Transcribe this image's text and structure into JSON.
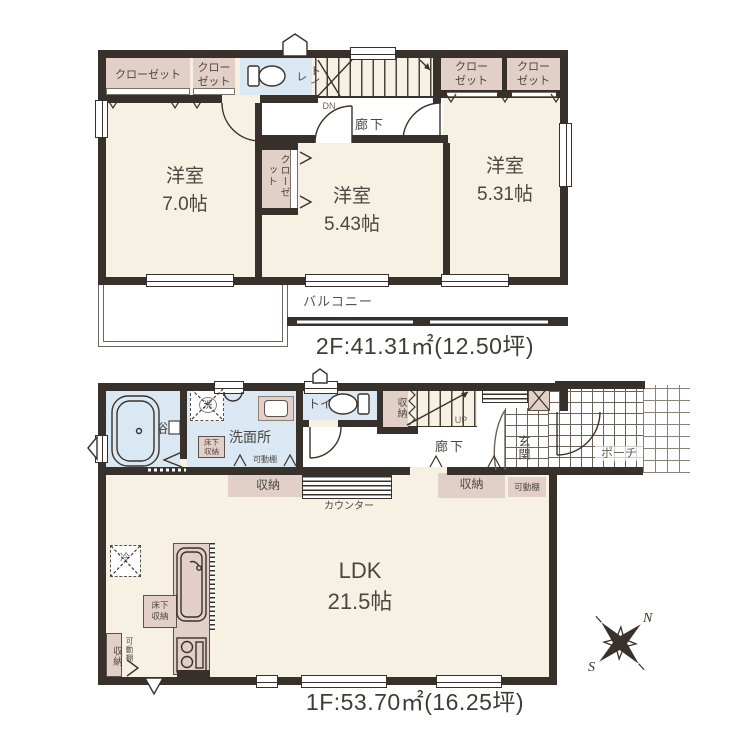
{
  "colors": {
    "wall": "#37302b",
    "floor_cream": "#f6f1e3",
    "closet_pink": "#e2cfc7",
    "water_blue": "#d9e8f2",
    "line_dark": "#3a312c",
    "text": "#4b4743"
  },
  "compass": {
    "north": "N",
    "south": "S"
  },
  "f2": {
    "area_text": "2F:41.31㎡(12.50坪)",
    "labels": {
      "closet_a": "クローゼット",
      "closet_b": "クロー\nゼット",
      "toilet": "トイレ",
      "stairs_dn": "DN",
      "hallway": "廊下",
      "closet_c": "クロー\nゼット",
      "closet_d": "クロー\nゼット",
      "closet_mid": "クローゼット",
      "room_a": "洋室\n7.0帖",
      "room_b": "洋室\n5.43帖",
      "room_c": "洋室\n5.31帖",
      "balcony": "バルコニー"
    }
  },
  "f1": {
    "area_text": "1F:53.70㎡(16.25坪)",
    "labels": {
      "bathroom": "浴室",
      "washer": "洗",
      "washroom": "洗面所",
      "underfloor_a": "床下\n収納",
      "shelf_a": "可動棚",
      "toilet": "トイレ",
      "storage_a": "収納",
      "stairs_up": "UP",
      "hallway": "廊下",
      "entrance": "玄関",
      "porch": "ポーチ",
      "storage_b": "収納",
      "counter": "カウンター",
      "storage_c": "収納",
      "shelf_b": "可動棚",
      "ldk": "LDK\n21.5帖",
      "fridge": "冷",
      "underfloor_b": "床下\n収納",
      "storage_d": "収納",
      "shelf_c": "可動棚"
    }
  }
}
